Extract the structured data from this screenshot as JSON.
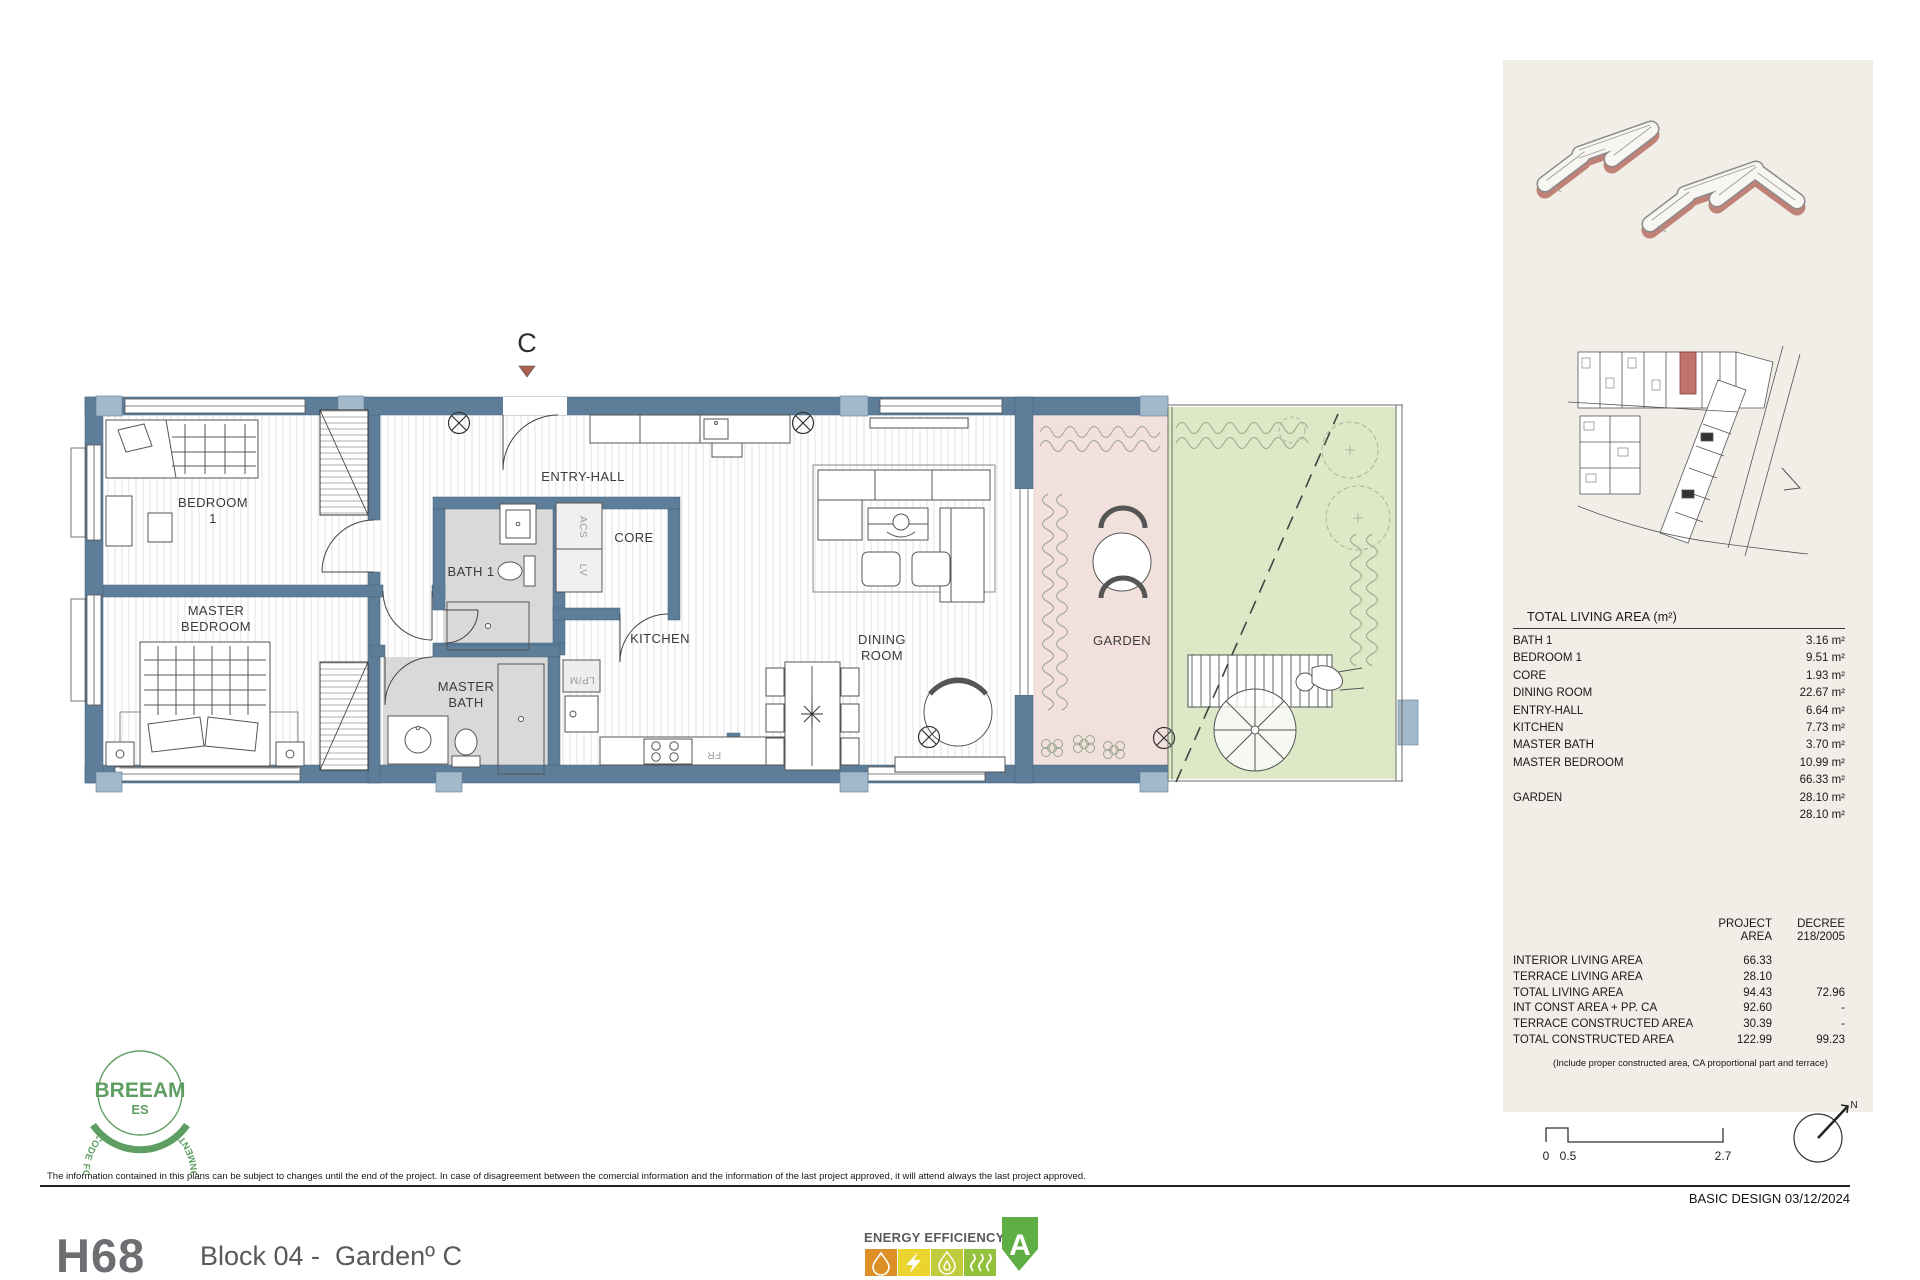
{
  "plan": {
    "marker": "C",
    "labels": {
      "bedroom1_1": "BEDROOM",
      "bedroom1_2": "1",
      "master_bedroom_1": "MASTER",
      "master_bedroom_2": "BEDROOM",
      "bath1": "BATH 1",
      "master_bath_1": "MASTER",
      "master_bath_2": "BATH",
      "entry_hall": "ENTRY-HALL",
      "core": "CORE",
      "kitchen": "KITCHEN",
      "dining_1": "DINING",
      "dining_2": "ROOM",
      "garden": "GARDEN",
      "acs": "ACS",
      "lv": "LV",
      "lpm": "LP/M",
      "fr": "FR"
    }
  },
  "sidebar": {
    "living_area_table": {
      "title": "TOTAL LIVING AREA (m²)",
      "rows": [
        {
          "label": "BATH 1",
          "value": "3.16 m²"
        },
        {
          "label": "BEDROOM 1",
          "value": "9.51 m²"
        },
        {
          "label": "CORE",
          "value": "1.93 m²"
        },
        {
          "label": "DINING ROOM",
          "value": "22.67 m²"
        },
        {
          "label": "ENTRY-HALL",
          "value": "6.64 m²"
        },
        {
          "label": "KITCHEN",
          "value": "7.73 m²"
        },
        {
          "label": "MASTER BATH",
          "value": "3.70 m²"
        },
        {
          "label": "MASTER BEDROOM",
          "value": "10.99 m²"
        },
        {
          "label": "",
          "value": "66.33 m²"
        },
        {
          "label": "GARDEN",
          "value": "28.10 m²"
        },
        {
          "label": "",
          "value": "28.10 m²"
        }
      ]
    },
    "summary_table": {
      "col_project_1": "PROJECT",
      "col_project_2": "AREA",
      "col_decree_1": "DECREE",
      "col_decree_2": "218/2005",
      "rows": [
        {
          "label": "INTERIOR LIVING AREA",
          "project": "66.33",
          "decree": ""
        },
        {
          "label": "TERRACE LIVING AREA",
          "project": "28.10",
          "decree": ""
        },
        {
          "label": "TOTAL LIVING AREA",
          "project": "94.43",
          "decree": "72.96"
        },
        {
          "label": "INT CONST AREA + PP. CA",
          "project": "92.60",
          "decree": "-"
        },
        {
          "label": "TERRACE CONSTRUCTED AREA",
          "project": "30.39",
          "decree": "-"
        },
        {
          "label": "TOTAL CONSTRUCTED AREA",
          "project": "122.99",
          "decree": "99.23"
        }
      ],
      "note": "(Include proper constructed area, CA proportional part and terrace)"
    },
    "scale_bar": {
      "t0": "0",
      "t1": "0.5",
      "t2": "2.7"
    },
    "compass_label": "N"
  },
  "footer": {
    "disclaimer": "The information contained in this plans can be subject to changes until the end of the project. In case of disagreement between the comercial information and the information of the last project approved, it will attend always the last project approved.",
    "basic_design": "BASIC DESIGN 03/12/2024"
  },
  "title_block": {
    "unit_code": "H68",
    "unit_name": "Block 04 -  Gardenº C"
  },
  "energy": {
    "heading": "ENERGY EFFICIENCY",
    "rating": "A"
  },
  "breeam": {
    "ring": "CODE FOR A SUSTAINABLE BUILT ENVIRONMENT",
    "name": "BREEAM",
    "region": "ES"
  },
  "colors": {
    "wall": "#5e7d99",
    "wall_light": "#a2b9ca",
    "terrace_pink": "#f2e0dc",
    "lawn_green": "#dce8c6",
    "bath_gray": "#d9d9d9",
    "panel_beige": "#f1ede7",
    "accent_red": "#b66a5e",
    "energy_orange": "#dd9027",
    "energy_yellow": "#ecd42e",
    "energy_lime": "#c2cb3b",
    "energy_green": "#93c13e",
    "energy_badge": "#5fae44",
    "breeam_green": "#5f9e63"
  }
}
